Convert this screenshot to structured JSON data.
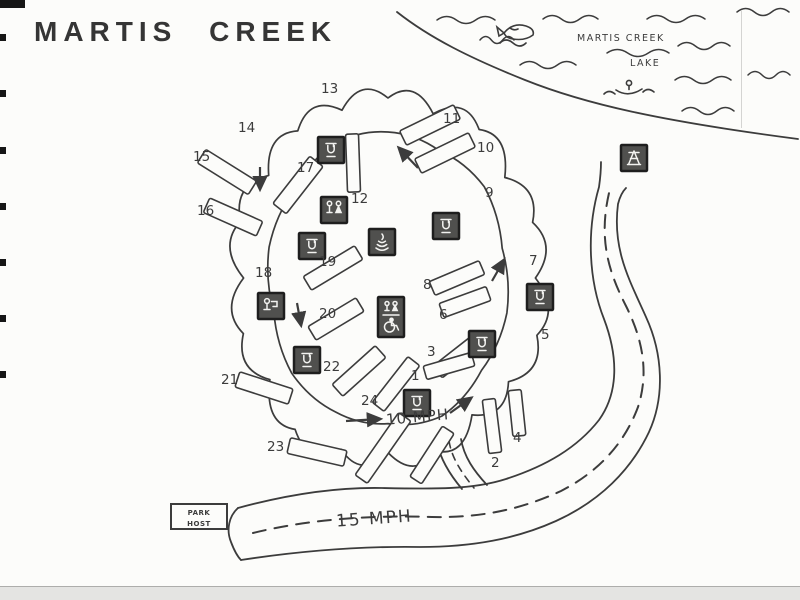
{
  "title": "MARTIS CREEK",
  "lake": {
    "line1": "MARTIS CREEK",
    "line2": "LAKE"
  },
  "labels": {
    "inner_speed": "10 MPH",
    "outer_speed": "15 MPH"
  },
  "park_host": {
    "line1": "PARK",
    "line2": "HOST"
  },
  "colors": {
    "ink": "#3c3c3c",
    "paper": "#fcfcfa",
    "icon_bg": "#50504e",
    "icon_border": "#1e1e1e",
    "icon_glyph": "#f2f2f0"
  },
  "map": {
    "sites": [
      {
        "n": "1",
        "x": 411,
        "y": 380
      },
      {
        "n": "2",
        "x": 491,
        "y": 467
      },
      {
        "n": "3",
        "x": 427,
        "y": 356
      },
      {
        "n": "4",
        "x": 513,
        "y": 442
      },
      {
        "n": "5",
        "x": 541,
        "y": 339
      },
      {
        "n": "6",
        "x": 439,
        "y": 319
      },
      {
        "n": "7",
        "x": 529,
        "y": 265
      },
      {
        "n": "8",
        "x": 423,
        "y": 289
      },
      {
        "n": "9",
        "x": 485,
        "y": 197
      },
      {
        "n": "10",
        "x": 477,
        "y": 152
      },
      {
        "n": "11",
        "x": 443,
        "y": 123
      },
      {
        "n": "12",
        "x": 351,
        "y": 203
      },
      {
        "n": "13",
        "x": 321,
        "y": 93
      },
      {
        "n": "14",
        "x": 238,
        "y": 132
      },
      {
        "n": "15",
        "x": 193,
        "y": 161
      },
      {
        "n": "16",
        "x": 197,
        "y": 215
      },
      {
        "n": "17",
        "x": 297,
        "y": 172
      },
      {
        "n": "18",
        "x": 255,
        "y": 277
      },
      {
        "n": "19",
        "x": 319,
        "y": 266
      },
      {
        "n": "20",
        "x": 319,
        "y": 318
      },
      {
        "n": "21",
        "x": 221,
        "y": 384
      },
      {
        "n": "22",
        "x": 323,
        "y": 371
      },
      {
        "n": "23",
        "x": 267,
        "y": 451
      },
      {
        "n": "24",
        "x": 361,
        "y": 405
      }
    ],
    "spurs": [
      {
        "cx": 227,
        "cy": 172,
        "angle": 32,
        "len": 60,
        "w": 16
      },
      {
        "cx": 233,
        "cy": 217,
        "angle": 24,
        "len": 58,
        "w": 16
      },
      {
        "cx": 298,
        "cy": 185,
        "angle": -52,
        "len": 60,
        "w": 17
      },
      {
        "cx": 353,
        "cy": 163,
        "angle": 88,
        "len": 58,
        "w": 13
      },
      {
        "cx": 430,
        "cy": 125,
        "angle": -26,
        "len": 60,
        "w": 16
      },
      {
        "cx": 445,
        "cy": 153,
        "angle": -26,
        "len": 60,
        "w": 16
      },
      {
        "cx": 457,
        "cy": 278,
        "angle": -23,
        "len": 54,
        "w": 15
      },
      {
        "cx": 465,
        "cy": 302,
        "angle": -20,
        "len": 50,
        "w": 15
      },
      {
        "cx": 458,
        "cy": 356,
        "angle": -38,
        "len": 52,
        "w": 15
      },
      {
        "cx": 449,
        "cy": 366,
        "angle": -16,
        "len": 50,
        "w": 14
      },
      {
        "cx": 492,
        "cy": 426,
        "angle": 83,
        "len": 54,
        "w": 13
      },
      {
        "cx": 517,
        "cy": 413,
        "angle": 84,
        "len": 46,
        "w": 13
      },
      {
        "cx": 333,
        "cy": 268,
        "angle": -31,
        "len": 60,
        "w": 16
      },
      {
        "cx": 336,
        "cy": 319,
        "angle": -31,
        "len": 56,
        "w": 16
      },
      {
        "cx": 359,
        "cy": 371,
        "angle": -42,
        "len": 58,
        "w": 16
      },
      {
        "cx": 396,
        "cy": 384,
        "angle": -52,
        "len": 58,
        "w": 15
      },
      {
        "cx": 264,
        "cy": 388,
        "angle": 18,
        "len": 56,
        "w": 16
      },
      {
        "cx": 317,
        "cy": 452,
        "angle": 13,
        "len": 58,
        "w": 16
      },
      {
        "cx": 383,
        "cy": 448,
        "angle": -55,
        "len": 76,
        "w": 15
      },
      {
        "cx": 432,
        "cy": 455,
        "angle": -57,
        "len": 60,
        "w": 14
      }
    ],
    "icons": [
      {
        "type": "water-faucet",
        "x": 318,
        "y": 137
      },
      {
        "type": "restroom",
        "x": 321,
        "y": 197
      },
      {
        "type": "water-faucet",
        "x": 299,
        "y": 233
      },
      {
        "type": "campfire",
        "x": 369,
        "y": 229
      },
      {
        "type": "water-faucet",
        "x": 433,
        "y": 213
      },
      {
        "type": "accessible-restroom",
        "x": 378,
        "y": 297
      },
      {
        "type": "dump-station",
        "x": 258,
        "y": 293
      },
      {
        "type": "water-faucet",
        "x": 527,
        "y": 284
      },
      {
        "type": "water-faucet",
        "x": 469,
        "y": 331
      },
      {
        "type": "water-faucet",
        "x": 294,
        "y": 347
      },
      {
        "type": "water-faucet",
        "x": 404,
        "y": 390
      },
      {
        "type": "picnic-table",
        "x": 621,
        "y": 145
      }
    ],
    "arrows": [
      {
        "x1": 418,
        "y1": 168,
        "x2": 399,
        "y2": 148
      },
      {
        "x1": 260,
        "y1": 167,
        "x2": 260,
        "y2": 189
      },
      {
        "x1": 297,
        "y1": 303,
        "x2": 301,
        "y2": 325
      },
      {
        "x1": 492,
        "y1": 281,
        "x2": 504,
        "y2": 260
      },
      {
        "x1": 450,
        "y1": 413,
        "x2": 471,
        "y2": 398
      },
      {
        "x1": 346,
        "y1": 421,
        "x2": 380,
        "y2": 419
      }
    ],
    "waves": [
      {
        "x": 437,
        "y": 20,
        "w": 58
      },
      {
        "x": 543,
        "y": 19,
        "w": 55
      },
      {
        "x": 647,
        "y": 19,
        "w": 58
      },
      {
        "x": 737,
        "y": 12,
        "w": 52
      },
      {
        "x": 480,
        "y": 40,
        "w": 34
      },
      {
        "x": 520,
        "y": 65,
        "w": 56
      },
      {
        "x": 607,
        "y": 53,
        "w": 62
      },
      {
        "x": 678,
        "y": 46,
        "w": 52
      },
      {
        "x": 675,
        "y": 80,
        "w": 56
      },
      {
        "x": 682,
        "y": 111,
        "w": 52
      },
      {
        "x": 748,
        "y": 75,
        "w": 42
      }
    ]
  }
}
